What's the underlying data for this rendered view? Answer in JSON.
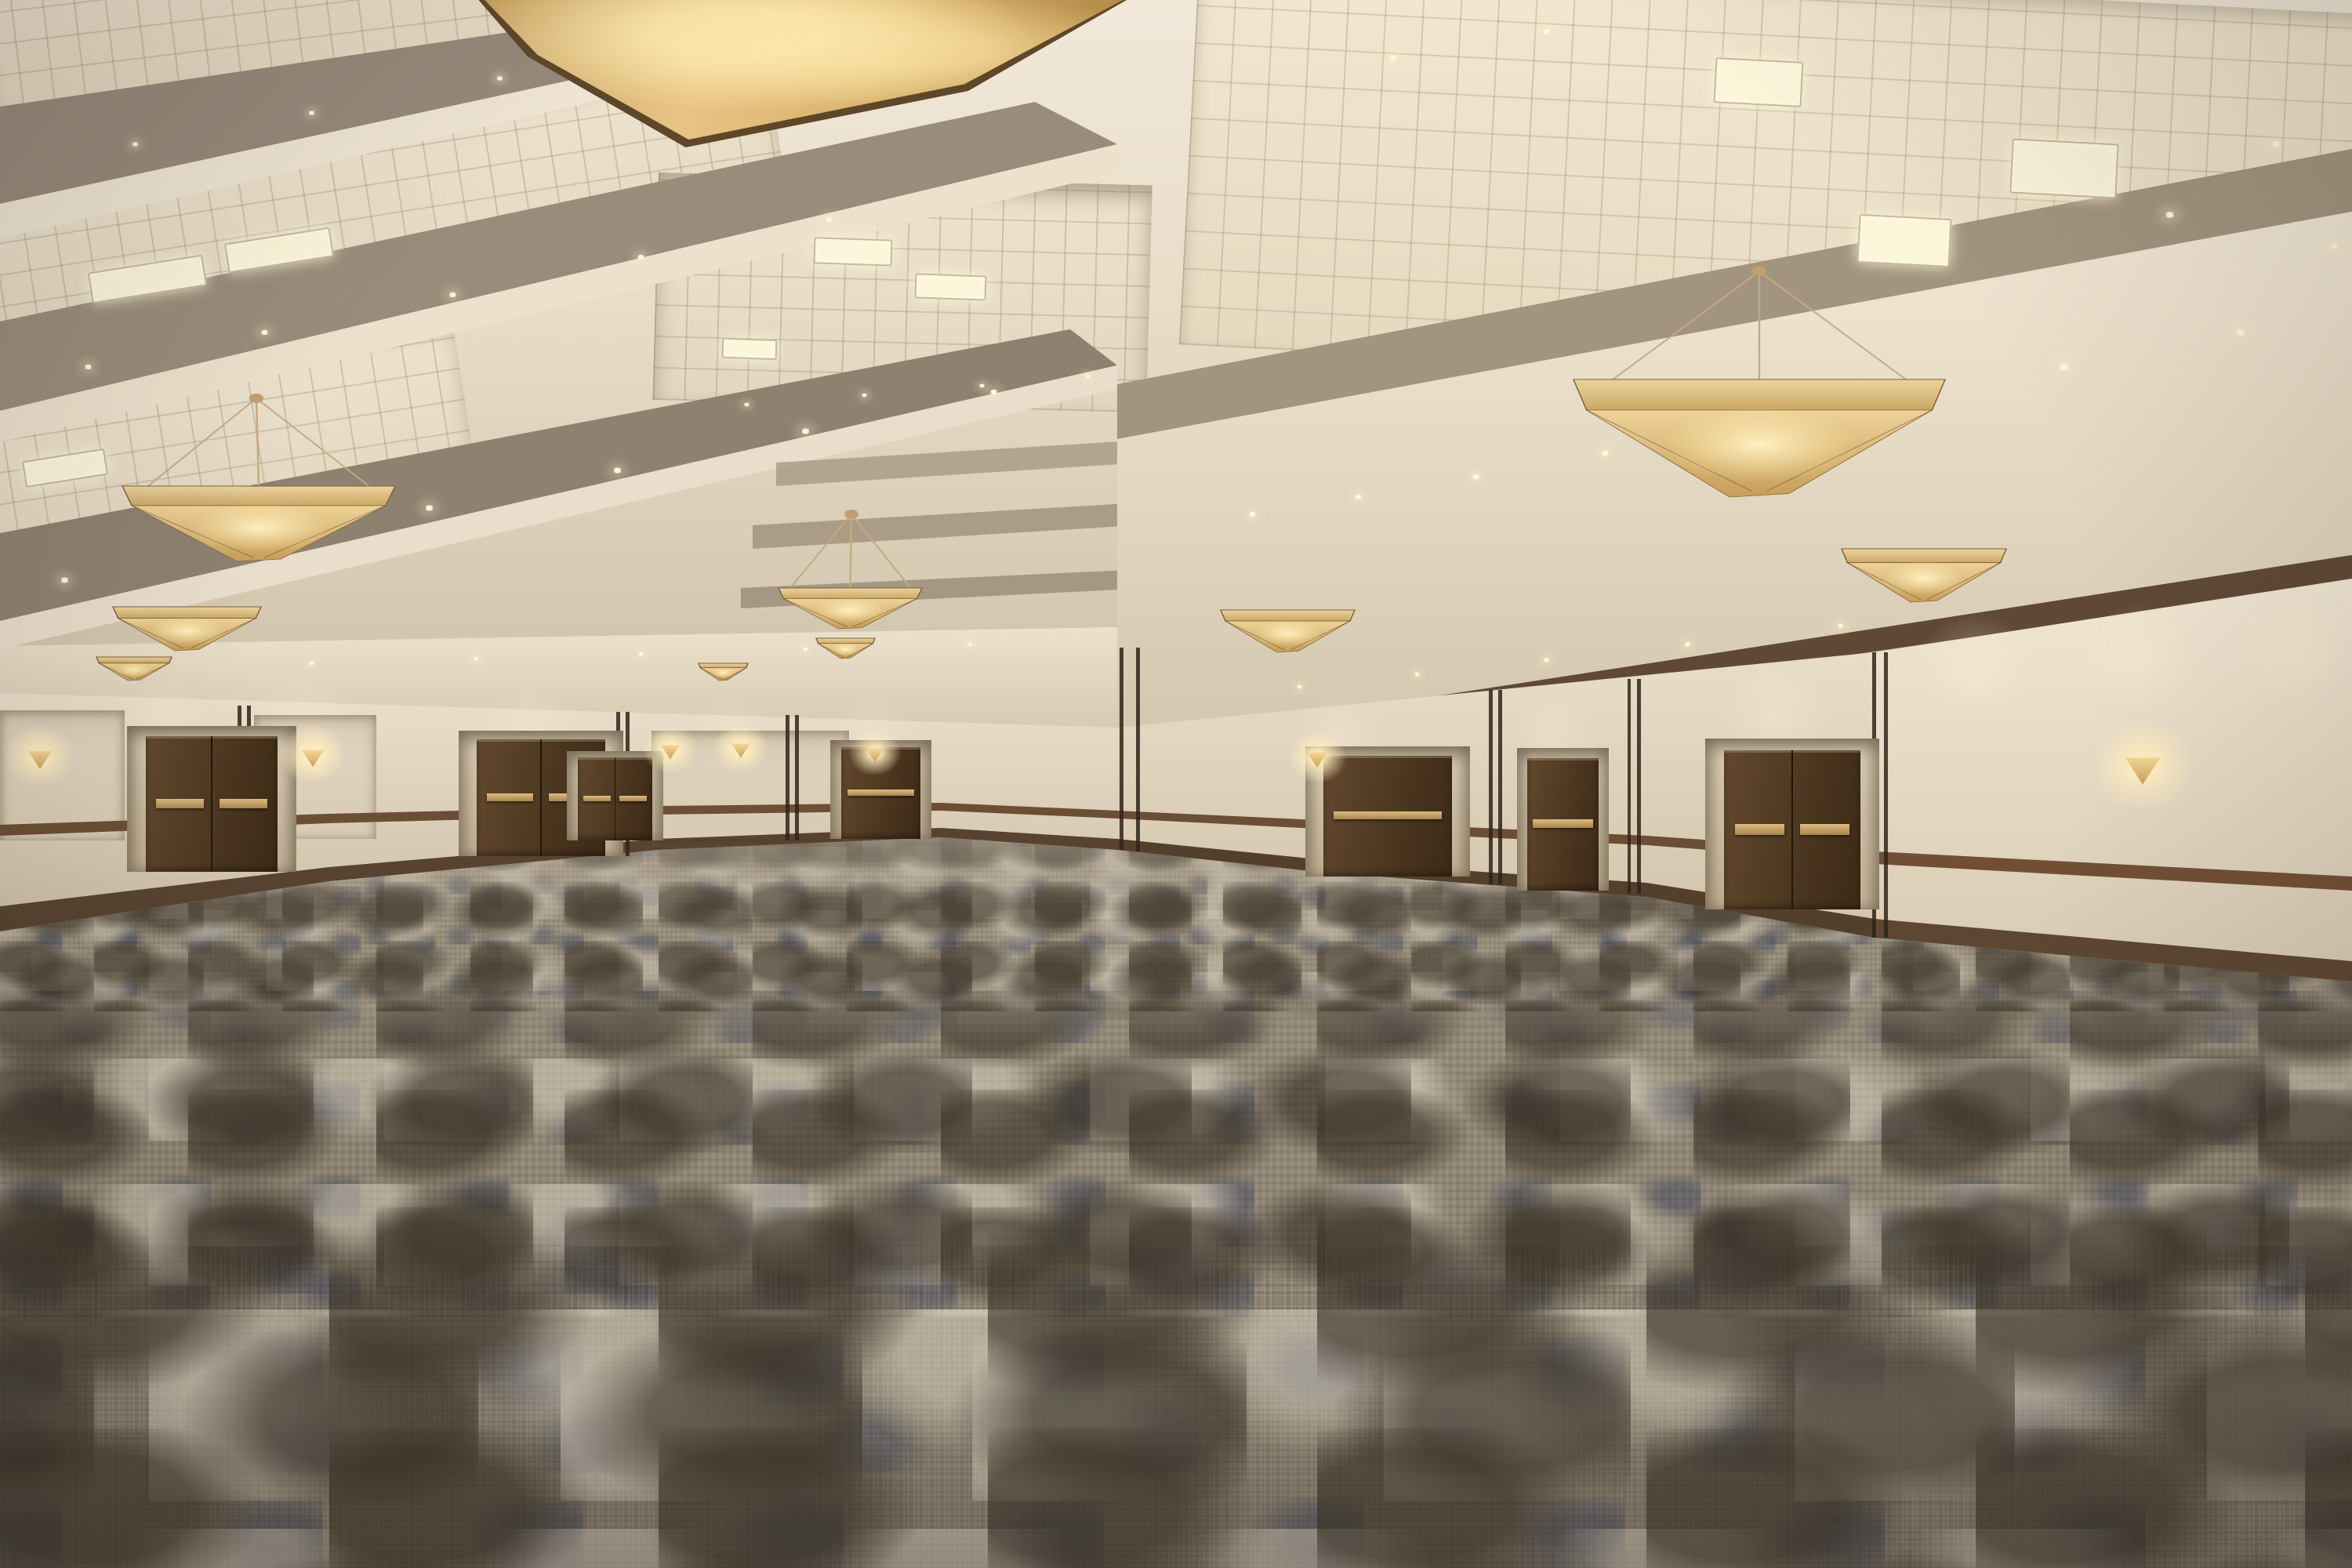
{
  "meta": {
    "description": "Empty hotel ballroom: coffered cream ceiling with amber inverted-pyramid chandeliers, recessed downlights and fluorescent tile panels, beige walls with dark wood doors, brass push bars, wood chair rails, triangular amber wall sconces, and a gray-taupe mottled carpet with cream and navy accents",
    "room_type": "ballroom / convention meeting space",
    "people_count": 0,
    "visible_text": ""
  },
  "palette": {
    "ceiling_cream": "#efe6d7",
    "beam_shadow_taupe": "#93876f",
    "soffit_light": "#f2e8d5",
    "wall_beige": "#e9dfcc",
    "trim_brown": "#5f4935",
    "door_brown": "#4c3720",
    "brass": "#d8b87c",
    "amber_glass": "#e6c384",
    "carpet_base": "#8e8473",
    "carpet_dark": "#4e4435",
    "carpet_light": "#d6ceBC",
    "carpet_navy": "#37415c"
  },
  "scene": {
    "ceiling": {
      "skylight": {
        "present": true,
        "shape": "amber stained glass with dark radial mullions"
      },
      "chandeliers": [
        {
          "x": 66.9,
          "y": 24.2,
          "w": 15.8,
          "h": 7.5,
          "canopy": [
            74.8,
            17.3
          ]
        },
        {
          "x": 5.2,
          "y": 31.0,
          "w": 11.6,
          "h": 4.8,
          "canopy": [
            10.9,
            25.4
          ]
        },
        {
          "x": 33.1,
          "y": 37.5,
          "w": 6.1,
          "h": 2.6,
          "canopy": [
            36.2,
            32.8
          ]
        },
        {
          "x": 78.3,
          "y": 35.0,
          "w": 7.0,
          "h": 3.4
        },
        {
          "x": 51.9,
          "y": 38.9,
          "w": 5.7,
          "h": 2.7
        },
        {
          "x": 4.8,
          "y": 38.7,
          "w": 6.3,
          "h": 2.8
        },
        {
          "x": 34.7,
          "y": 40.7,
          "w": 2.5,
          "h": 1.3
        },
        {
          "x": 29.7,
          "y": 42.3,
          "w": 2.1,
          "h": 1.1
        },
        {
          "x": 4.1,
          "y": 41.9,
          "w": 3.2,
          "h": 1.5
        }
      ],
      "light_panels": [
        {
          "x": 72.9,
          "y": 3.8,
          "w": 3.6,
          "h": 2.7,
          "r": 3
        },
        {
          "x": 85.5,
          "y": 9.0,
          "w": 4.4,
          "h": 3.3,
          "r": 3
        },
        {
          "x": 79.0,
          "y": 13.8,
          "w": 3.8,
          "h": 2.9,
          "r": 3
        },
        {
          "x": 3.8,
          "y": 16.8,
          "w": 4.8,
          "h": 1.8,
          "r": -9
        },
        {
          "x": 9.6,
          "y": 15.0,
          "w": 4.4,
          "h": 1.7,
          "r": -9
        },
        {
          "x": 1.0,
          "y": 29.0,
          "w": 3.4,
          "h": 1.5,
          "r": -9
        },
        {
          "x": 34.6,
          "y": 15.2,
          "w": 3.2,
          "h": 1.5,
          "r": 2
        },
        {
          "x": 38.9,
          "y": 17.5,
          "w": 2.9,
          "h": 1.4,
          "r": 2
        },
        {
          "x": 30.7,
          "y": 21.6,
          "w": 2.2,
          "h": 1.1,
          "r": 2
        }
      ],
      "downlights": [
        [
          5.5,
          9.0,
          0.7
        ],
        [
          13,
          7.0,
          0.7
        ],
        [
          21,
          4.8,
          0.7
        ],
        [
          29,
          2.7,
          0.7
        ],
        [
          3.5,
          23.2,
          0.8
        ],
        [
          11,
          21.0,
          0.8
        ],
        [
          19,
          18.6,
          0.8
        ],
        [
          27,
          16.2,
          0.8
        ],
        [
          35,
          13.8,
          0.8
        ],
        [
          2.5,
          36.8,
          0.9
        ],
        [
          10,
          34.6,
          0.9
        ],
        [
          18,
          32.2,
          0.9
        ],
        [
          26,
          29.8,
          0.9
        ],
        [
          34,
          27.3,
          0.9
        ],
        [
          42,
          24.8,
          0.8
        ],
        [
          6,
          42.4,
          0.6
        ],
        [
          13,
          42.1,
          0.6
        ],
        [
          20,
          41.8,
          0.6
        ],
        [
          27,
          41.5,
          0.6
        ],
        [
          34,
          41.2,
          0.6
        ],
        [
          41,
          40.9,
          0.6
        ],
        [
          53,
          32.6,
          0.8
        ],
        [
          57.5,
          31.5,
          0.8
        ],
        [
          62.5,
          30.2,
          0.9
        ],
        [
          68,
          28.7,
          0.9
        ],
        [
          74,
          27.0,
          1.0
        ],
        [
          80.5,
          25.2,
          1.0
        ],
        [
          87.5,
          23.2,
          1.1
        ],
        [
          95,
          21.0,
          1.1
        ],
        [
          55,
          43.6,
          0.6
        ],
        [
          60,
          42.8,
          0.6
        ],
        [
          65.5,
          41.9,
          0.7
        ],
        [
          71.5,
          40.9,
          0.7
        ],
        [
          78,
          39.7,
          0.7
        ],
        [
          59,
          3.5,
          0.9
        ],
        [
          65.5,
          1.8,
          0.9
        ],
        [
          92,
          13.5,
          1.0
        ],
        [
          96.5,
          9.0,
          1.0
        ],
        [
          99,
          15.5,
          0.9
        ],
        [
          31.5,
          25.6,
          0.6
        ],
        [
          36.5,
          25.0,
          0.6
        ],
        [
          41.5,
          24.4,
          0.6
        ],
        [
          46,
          23.8,
          0.6
        ]
      ]
    },
    "walls": {
      "sconces": [
        {
          "x": 1.2,
          "y": 47.9,
          "s": 1.0
        },
        {
          "x": 12.8,
          "y": 47.8,
          "s": 0.95
        },
        {
          "x": 28.0,
          "y": 47.4,
          "s": 0.8
        },
        {
          "x": 31.0,
          "y": 47.3,
          "s": 0.8
        },
        {
          "x": 36.7,
          "y": 47.6,
          "s": 0.75
        },
        {
          "x": 55.5,
          "y": 47.9,
          "s": 0.85
        },
        {
          "x": 90.6,
          "y": 48.6,
          "s": 1.5
        }
      ],
      "doors": [
        {
          "x": 6.5,
          "y": 47.0,
          "w": 5.0,
          "h": 8.6,
          "type": "double"
        },
        {
          "x": 20.6,
          "y": 47.3,
          "w": 4.8,
          "h": 7.3,
          "type": "double"
        },
        {
          "x": 25.2,
          "y": 48.6,
          "w": 1.9,
          "h": 5.0,
          "type": "double"
        },
        {
          "x": 36.4,
          "y": 47.9,
          "w": 2.1,
          "h": 5.6,
          "type": "single"
        },
        {
          "x": 56.6,
          "y": 48.3,
          "w": 4.8,
          "h": 7.6,
          "type": "single"
        },
        {
          "x": 65.6,
          "y": 48.4,
          "w": 1.7,
          "h": 8.4,
          "type": "single"
        },
        {
          "x": 73.6,
          "y": 47.8,
          "w": 5.2,
          "h": 10.2,
          "type": "double"
        }
      ],
      "panels": [
        {
          "x": 0,
          "y": 45.3,
          "w": 5.3,
          "h": 8.3
        },
        {
          "x": 10.8,
          "y": 45.6,
          "w": 5.2,
          "h": 7.9
        },
        {
          "x": 27.7,
          "y": 46.6,
          "w": 8.4,
          "h": 7.4
        }
      ],
      "seams": [
        {
          "x": 10.1,
          "t": 45.0,
          "b": 55.6
        },
        {
          "x": 10.5,
          "t": 45.0,
          "b": 55.6
        },
        {
          "x": 26.2,
          "t": 45.4,
          "b": 54.6
        },
        {
          "x": 26.6,
          "t": 45.4,
          "b": 54.6
        },
        {
          "x": 33.4,
          "t": 45.6,
          "b": 53.6
        },
        {
          "x": 33.8,
          "t": 45.6,
          "b": 53.6
        },
        {
          "x": 47.6,
          "t": 41.3,
          "b": 54.2
        },
        {
          "x": 48.3,
          "t": 41.3,
          "b": 54.3
        },
        {
          "x": 63.3,
          "t": 44.0,
          "b": 56.4
        },
        {
          "x": 63.7,
          "t": 44.0,
          "b": 56.4
        },
        {
          "x": 69.2,
          "t": 43.3,
          "b": 57.0
        },
        {
          "x": 69.6,
          "t": 43.3,
          "b": 57.0
        },
        {
          "x": 79.6,
          "t": 41.6,
          "b": 59.8
        },
        {
          "x": 80.1,
          "t": 41.6,
          "b": 59.8
        }
      ]
    }
  }
}
